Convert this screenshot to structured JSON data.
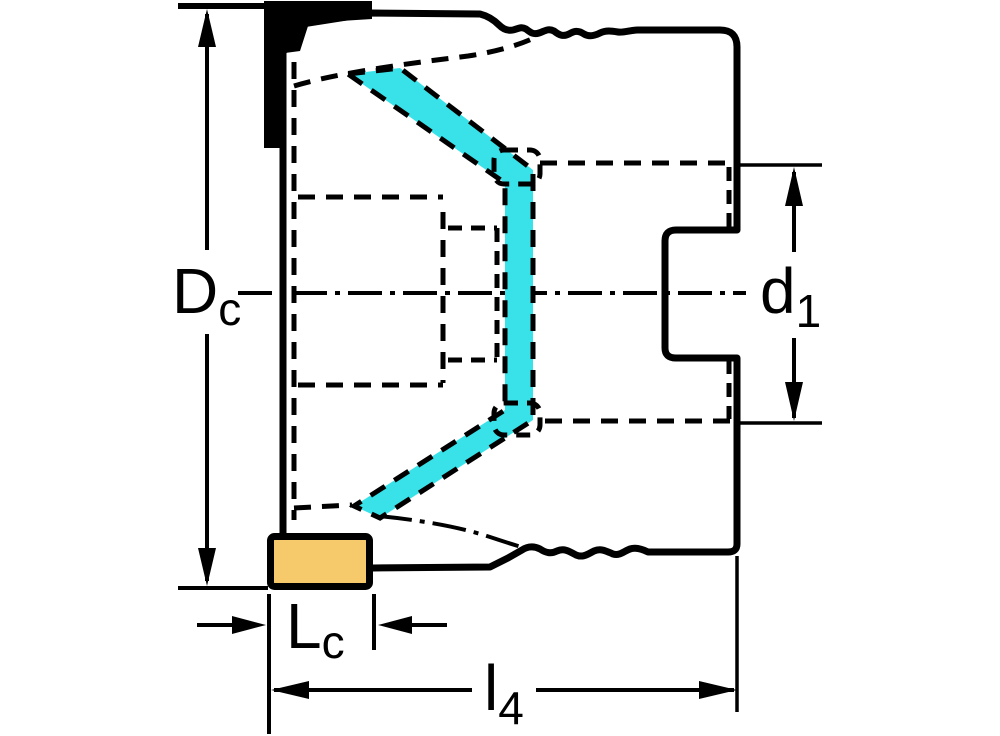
{
  "drawing": {
    "kind": "technical-dimension-drawing",
    "view": "milling-cutter-side-section",
    "labels": {
      "Dc": {
        "main": "D",
        "sub": "c"
      },
      "d1": {
        "main": "d",
        "sub": "1"
      },
      "Lc": {
        "main": "L",
        "sub": "c"
      },
      "l4": {
        "main": "l",
        "sub": "4"
      }
    },
    "colors": {
      "background": "#ffffff",
      "body_fill": "#c7c7c7",
      "outline": "#000000",
      "highlight": "#38e2e8",
      "insert_fill": "#f6c96b",
      "top_insert_fill": "#000000"
    }
  }
}
